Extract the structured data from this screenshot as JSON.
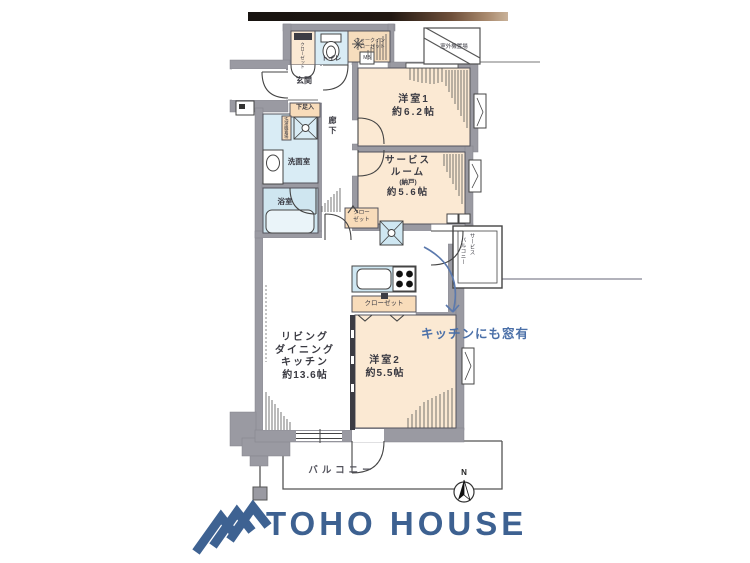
{
  "plan": {
    "rooms": {
      "western1": {
        "name": "洋室1",
        "size": "約6.2帖"
      },
      "service_room": {
        "lines": [
          "サービス",
          "ルーム",
          "(納戸)",
          "約5.6帖"
        ]
      },
      "ldk": {
        "lines": [
          "リビング",
          "ダイニング",
          "キッチン",
          "約13.6帖"
        ]
      },
      "western2": {
        "name": "洋室2",
        "size": "約5.5帖"
      },
      "balcony": "バルコニー",
      "service_balcony": {
        "line1": "サービス",
        "line2": "バルコニー"
      },
      "outdoor_unit": "室外機置場",
      "wic": {
        "line1": "ウォークイン",
        "line2": "クローゼット"
      },
      "toilet": "トイレ",
      "entrance": "玄関",
      "entrance_closet": "クローゼット",
      "shoe_box": "下足入",
      "laundry": "洗濯機置場",
      "washroom": "洗面室",
      "bathroom": "浴室",
      "corridor": "廊下",
      "sr_closet": {
        "line1": "クロー",
        "line2": "ゼット"
      },
      "wr2_closet": "クローゼット",
      "meter_box": "MB"
    },
    "annotation": {
      "text": "キッチンにも窓有",
      "color": "#4a6fa8"
    },
    "compass_n": "N"
  },
  "branding": {
    "logo_text": "TOHO HOUSE",
    "logo_color": "#3d6191"
  },
  "colors": {
    "wall": "#9a9aa2",
    "room_cream": "#fbe9d3",
    "closet_tan": "#f8dcba",
    "wet_blue": "#d9ecf5",
    "counter_blue": "#cfe7f2",
    "line": "#53535c",
    "annotation_blue": "#4a6fa8",
    "logo_blue": "#3d6191",
    "top_bar_dark": "#171310",
    "top_bar_brown": "#b0916f"
  }
}
